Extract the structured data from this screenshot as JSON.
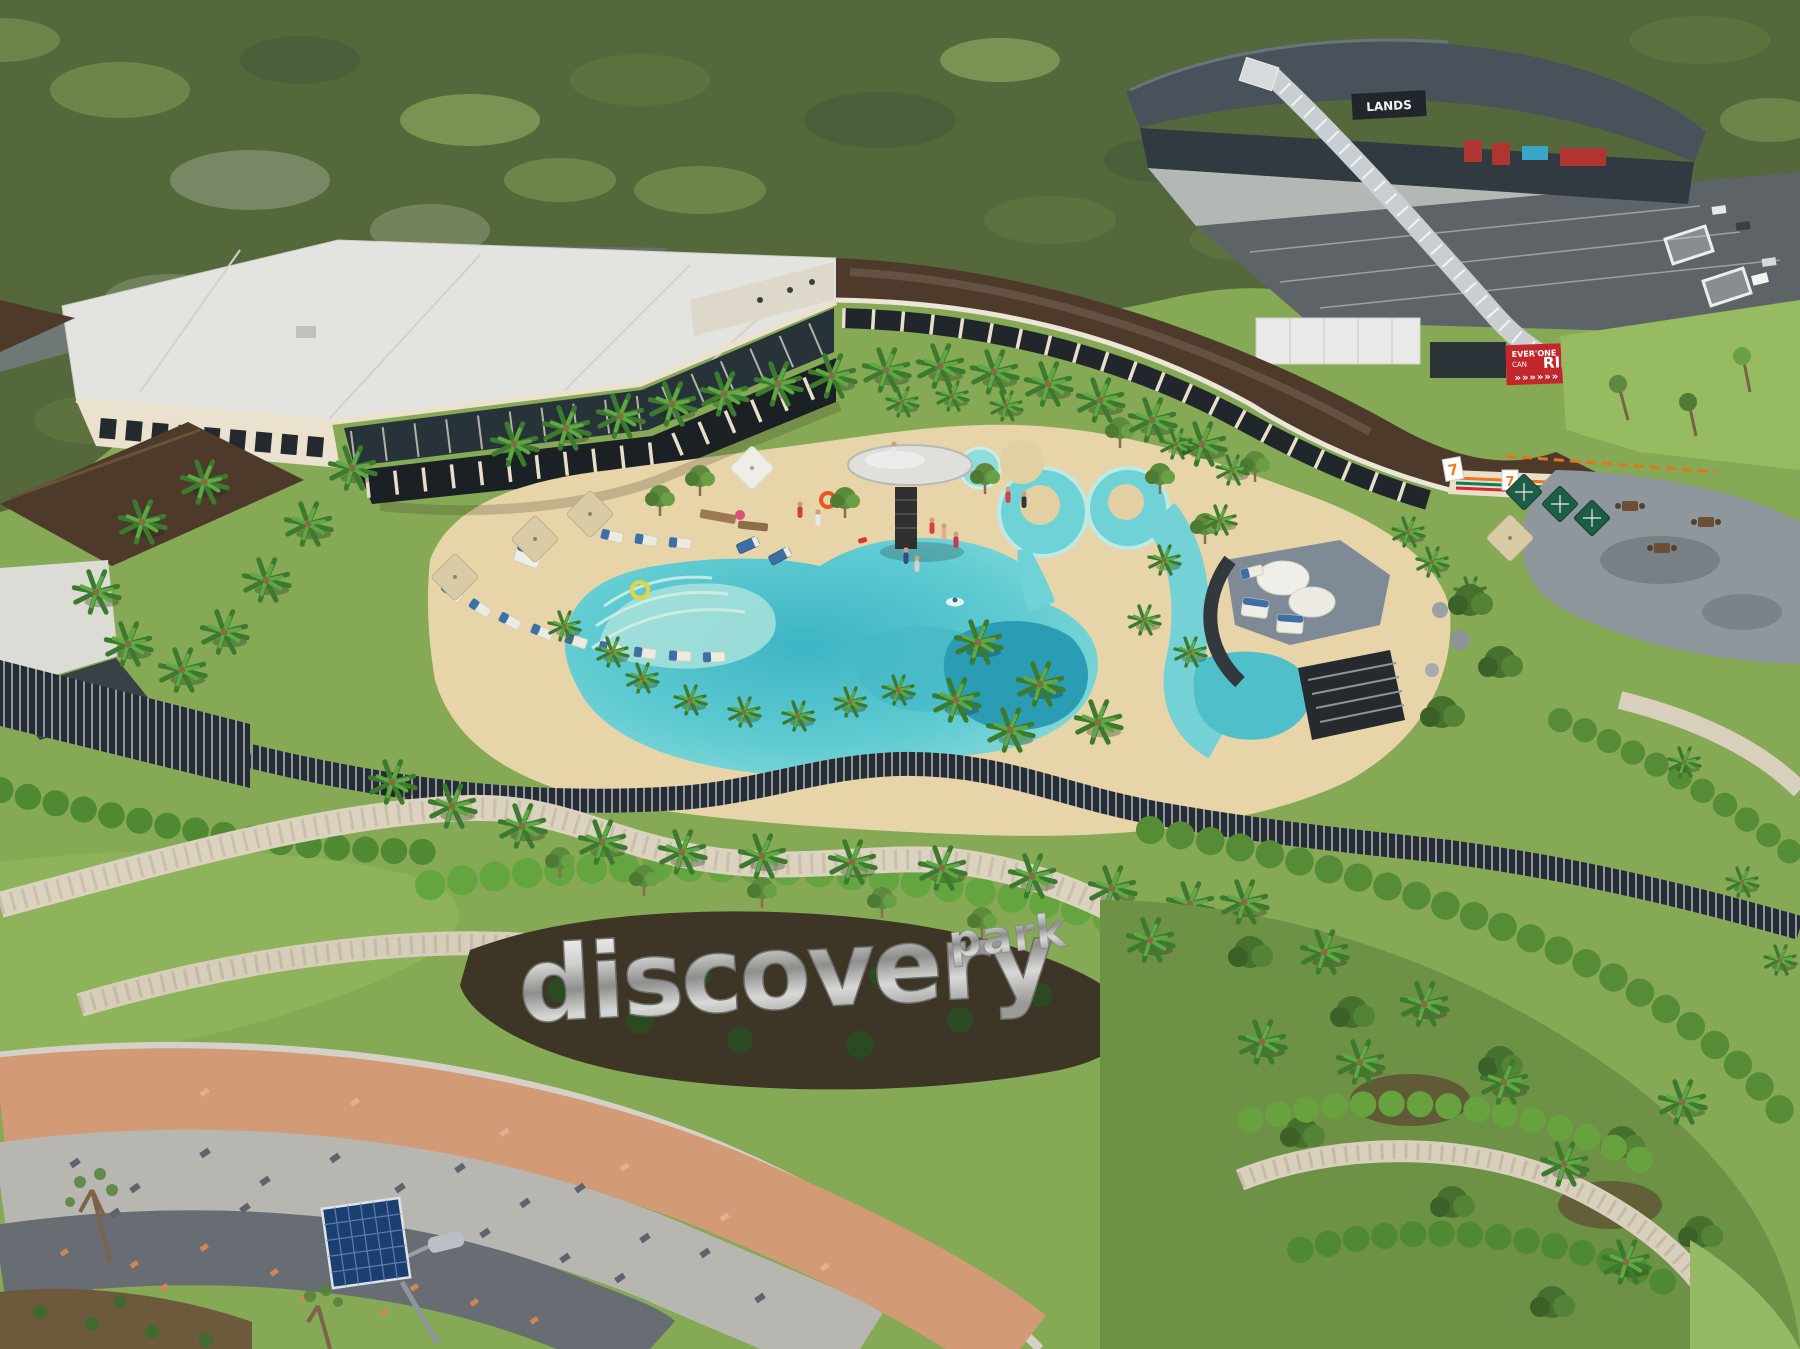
{
  "scene": {
    "description": "Aerial drone photograph of a tropical resort clubhouse with a free-form lagoon swimming pool, palm trees, landscaped gardens with a metallic 'discovery park' sign, a curved brown-roof wing with a 7-Eleven store, a distant event venue with parking, and a tri-colored paver promenade with a solar street lamp.",
    "signage": {
      "park_sign_main": "discovery",
      "park_sign_sub": "park",
      "billboard_top": "EVER'ONE",
      "billboard_mid": "CAN",
      "billboard_main": "RIDE",
      "billboard_arrows": "»»»»»»",
      "convenience_logo": "7",
      "venue_sign": "LANDS"
    },
    "colors": {
      "forest": "#55683b",
      "lawn": "#86a956",
      "lawn_bright": "#8fb35a",
      "pool": "#5fcbd2",
      "pool_deep": "#2a9db5",
      "sand_deck": "#e7d4a8",
      "building_cream": "#eae1ce",
      "roof_white": "#e3e3df",
      "roof_brown": "#4e3a2b",
      "glass_dark": "#273338",
      "fence_dark": "#272c32",
      "stone_wall": "#dbd2bf",
      "hedge_green": "#5d9140",
      "paver_salmon": "#d29b76",
      "paver_grey": "#b7b6b0",
      "paver_dark": "#686d74",
      "umbrella_green": "#1d5c46",
      "cushion_blue": "#3d6fa5",
      "billboard_red": "#c2272e",
      "solar_panel": "#1c3f72",
      "asphalt": "#5e6367",
      "distant_roof": "#49525a",
      "patio_grey": "#8e979c"
    }
  }
}
